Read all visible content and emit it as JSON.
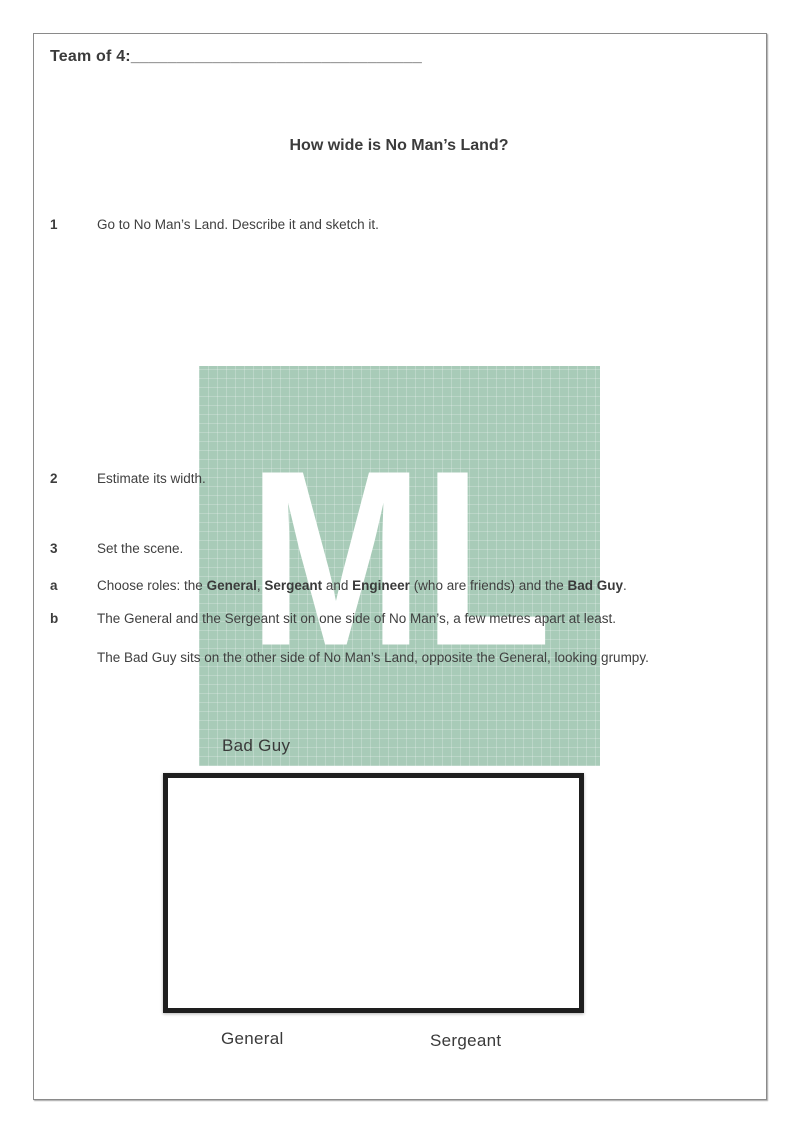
{
  "document": {
    "team": {
      "label": "Team of 4:",
      "blank": "________________________________"
    },
    "title": "How wide is No Man’s Land?",
    "questions": [
      {
        "marker": "1",
        "text": "Go to No Man’s Land. Describe it and sketch it."
      },
      {
        "marker": "2",
        "text": "Estimate its width."
      },
      {
        "marker": "3",
        "text": "Set the scene."
      }
    ],
    "item_a": {
      "marker": "a",
      "segments": [
        {
          "t": "Choose roles: the ",
          "b": false
        },
        {
          "t": "General",
          "b": true
        },
        {
          "t": ", ",
          "b": false
        },
        {
          "t": "Sergeant",
          "b": true
        },
        {
          "t": " and ",
          "b": false
        },
        {
          "t": "Engineer",
          "b": true
        },
        {
          "t": " (who are friends) and the ",
          "b": false
        },
        {
          "t": "Bad Guy",
          "b": true
        },
        {
          "t": ".",
          "b": false
        }
      ]
    },
    "item_b": {
      "marker": "b",
      "line1": "The General and the Sergeant sit on one side of No Man’s, a few metres apart at least.",
      "line2": "The Bad Guy sits on the other side of No Man’s Land, opposite the General, looking grumpy."
    },
    "diagram": {
      "top_label": "Bad Guy",
      "bottom_left_label": "General",
      "bottom_right_label": "Sergeant"
    },
    "watermark": {
      "text": "ML",
      "background": "#a8cbb8",
      "letter_color": "#ffffff",
      "text_color": "#3f3f3f"
    }
  }
}
